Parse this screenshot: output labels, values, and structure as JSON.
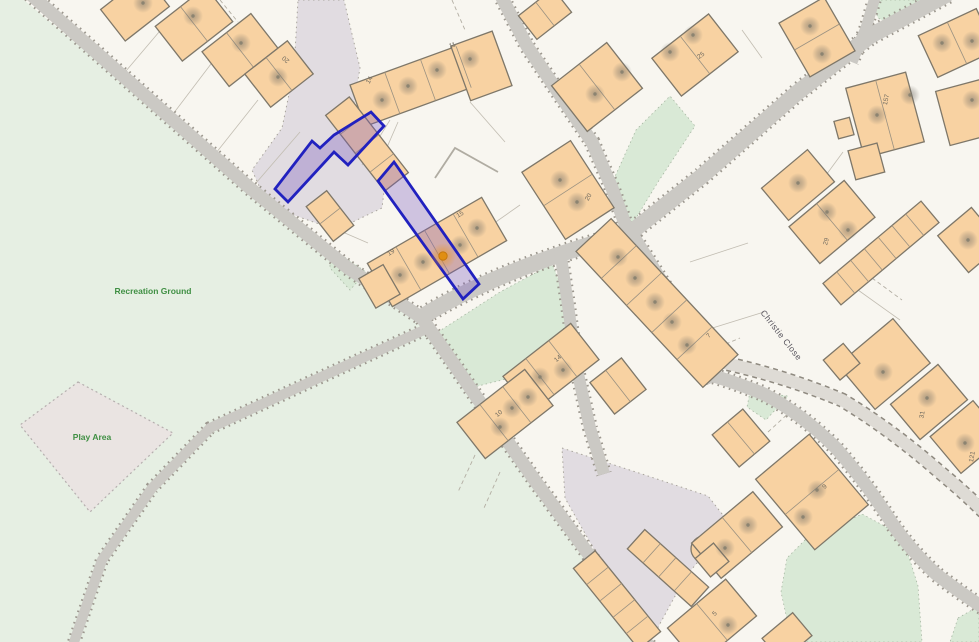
{
  "map": {
    "area_labels": [
      {
        "text": "Recreation Ground",
        "x": 153,
        "y": 294
      },
      {
        "text": "Play Area",
        "x": 92,
        "y": 440
      }
    ],
    "street_labels": [
      {
        "text": "Christie Close",
        "x": 779,
        "y": 337,
        "rot": 52
      }
    ],
    "house_numbers": [
      {
        "text": "20",
        "x": 287,
        "y": 58,
        "rot": -140
      },
      {
        "text": "14",
        "x": 371,
        "y": 81,
        "rot": -60
      },
      {
        "text": "11",
        "x": 453,
        "y": 47,
        "rot": -20
      },
      {
        "text": "15",
        "x": 461,
        "y": 216,
        "rot": -30
      },
      {
        "text": "19",
        "x": 392,
        "y": 254,
        "rot": -32
      },
      {
        "text": "20",
        "x": 590,
        "y": 198,
        "rot": -60
      },
      {
        "text": "25",
        "x": 702,
        "y": 57,
        "rot": -35
      },
      {
        "text": "7",
        "x": 710,
        "y": 337,
        "rot": -45
      },
      {
        "text": "14",
        "x": 559,
        "y": 360,
        "rot": -40
      },
      {
        "text": "10",
        "x": 500,
        "y": 415,
        "rot": -40
      },
      {
        "text": "157",
        "x": 888,
        "y": 100,
        "rot": -78
      },
      {
        "text": "29",
        "x": 828,
        "y": 242,
        "rot": -75
      },
      {
        "text": "31",
        "x": 924,
        "y": 415,
        "rot": -80
      },
      {
        "text": "9",
        "x": 826,
        "y": 488,
        "rot": -45
      },
      {
        "text": "5",
        "x": 716,
        "y": 615,
        "rot": -45
      },
      {
        "text": "121",
        "x": 974,
        "y": 457,
        "rot": -80
      }
    ],
    "subject_marker": {
      "x": 443,
      "y": 256
    },
    "address_points": [
      [
        143,
        3
      ],
      [
        193,
        16
      ],
      [
        241,
        43
      ],
      [
        278,
        77
      ],
      [
        382,
        100
      ],
      [
        408,
        86
      ],
      [
        437,
        70
      ],
      [
        470,
        59
      ],
      [
        560,
        180
      ],
      [
        577,
        202
      ],
      [
        595,
        94
      ],
      [
        622,
        72
      ],
      [
        670,
        52
      ],
      [
        693,
        35
      ],
      [
        810,
        26
      ],
      [
        822,
        54
      ],
      [
        942,
        43
      ],
      [
        972,
        41
      ],
      [
        877,
        115
      ],
      [
        910,
        95
      ],
      [
        972,
        100
      ],
      [
        400,
        275
      ],
      [
        423,
        262
      ],
      [
        460,
        245
      ],
      [
        477,
        228
      ],
      [
        618,
        257
      ],
      [
        635,
        278
      ],
      [
        655,
        302
      ],
      [
        672,
        322
      ],
      [
        687,
        345
      ],
      [
        500,
        427
      ],
      [
        512,
        408
      ],
      [
        528,
        397
      ],
      [
        540,
        377
      ],
      [
        563,
        370
      ],
      [
        798,
        183
      ],
      [
        827,
        212
      ],
      [
        848,
        230
      ],
      [
        883,
        372
      ],
      [
        927,
        398
      ],
      [
        965,
        443
      ],
      [
        968,
        240
      ],
      [
        817,
        490
      ],
      [
        803,
        517
      ],
      [
        748,
        525
      ],
      [
        725,
        548
      ],
      [
        728,
        625
      ]
    ],
    "colors": {
      "background": "#f8f6f0",
      "green_area": "#e6efe3",
      "green_patch": "#d9e9d6",
      "play_area": "#eae4e2",
      "hardstanding": "#e1dce1",
      "road": "#cbc9c4",
      "road_dot": "#9c978e",
      "building": "#f8d2a2",
      "building_outline": "#7e7769",
      "boundary_blue": "#2121bf",
      "boundary_fill": "rgba(120,86,190,0.32)",
      "marker_orange": "#e08e12",
      "label_green": "#3f8f43",
      "label_street": "#55525b",
      "label_number": "#6f6a5f"
    }
  }
}
